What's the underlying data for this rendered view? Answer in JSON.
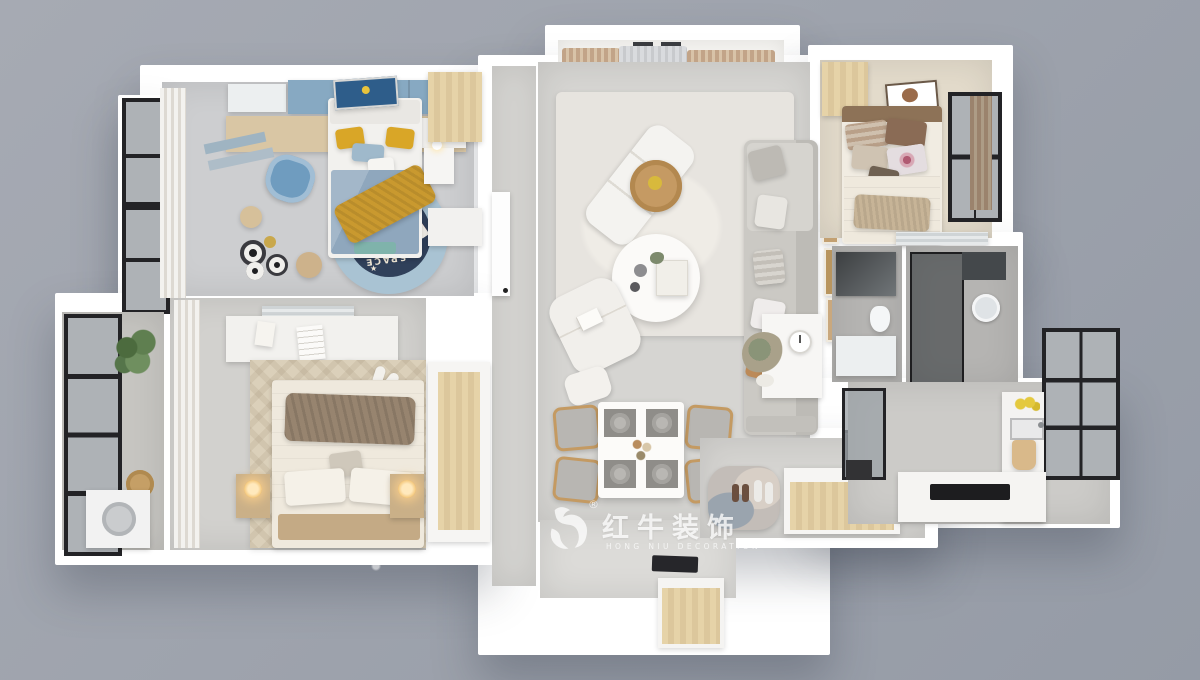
{
  "scene": {
    "description": "3D top-down rendering of a three-bedroom apartment interior floor plan on a gray backdrop",
    "rooms": [
      "kids-bedroom-study",
      "bay-window-nook",
      "living-room",
      "dining-area",
      "secondary-bedroom",
      "bathroom-vanity",
      "bathroom-shower",
      "kitchen",
      "master-bedroom",
      "utility-balcony",
      "entry-foyer"
    ]
  },
  "watermark": {
    "logo_icon": "bull-logo",
    "registered_symbol": "®",
    "brand_cn": "红牛装饰",
    "brand_en": "HONG NIU DECORATION",
    "text_color": "#ffffff"
  },
  "kids_room": {
    "rug_text": "SPACE"
  },
  "colors": {
    "bg1": "#a6aab3",
    "bg2": "#959ba6",
    "wall": "#ffffff",
    "floorgray": "#d6d5d2",
    "floorcool": "#cdced0",
    "floorwarm": "#e3dbcb",
    "tiledark": "#b5b4b2",
    "wood": "#d9c6a4",
    "woodlight": "#e6d3a8",
    "wooddark": "#c4aa85",
    "blue": "#87a9c2",
    "bluechair": "#6f9cbf",
    "navy": "#30405a",
    "rugblue": "#a9c3d3",
    "mustard": "#d9a627",
    "gold": "#c9992f",
    "curtain": "#c2a488",
    "sofa": "#cbc9c4",
    "caramel": "#bc8a58",
    "plant": "#5f7f50",
    "dark": "#232326",
    "glass": "#aeb2b6",
    "cream": "#efe9dd",
    "brownthrow": "#97846f"
  }
}
